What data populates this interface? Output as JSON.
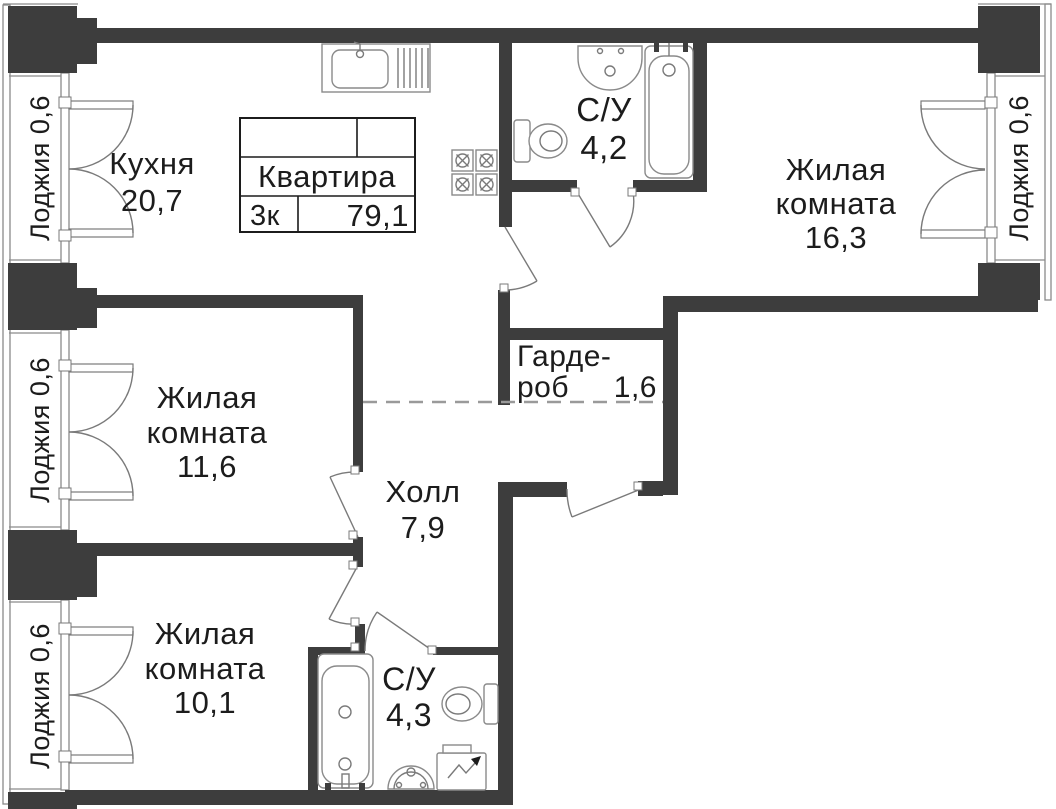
{
  "title_block": {
    "title": "Квартира",
    "rooms_count": "3к",
    "total_area": "79,1"
  },
  "rooms": {
    "kitchen": {
      "name": "Кухня",
      "area": "20,7"
    },
    "bathroom_top": {
      "name": "С/У",
      "area": "4,2"
    },
    "living_room_large": {
      "name_line1": "Жилая",
      "name_line2": "комната",
      "area": "16,3"
    },
    "wardrobe": {
      "name_line1": "Гарде-",
      "name_line2": "роб",
      "area": "1,6"
    },
    "living_room_mid": {
      "name_line1": "Жилая",
      "name_line2": "комната",
      "area": "11,6"
    },
    "hall": {
      "name": "Холл",
      "area": "7,9"
    },
    "living_room_small": {
      "name_line1": "Жилая",
      "name_line2": "комната",
      "area": "10,1"
    },
    "bathroom_bottom": {
      "name": "С/У",
      "area": "4,3"
    },
    "loggia": {
      "label": "Лоджия 0,6"
    }
  },
  "colors": {
    "wall": "#3d3d3d",
    "line": "#8a8a8a",
    "door": "#7a7a7a",
    "dash": "#9a9a9a",
    "text": "#1c1c1c",
    "bg": "#ffffff"
  }
}
